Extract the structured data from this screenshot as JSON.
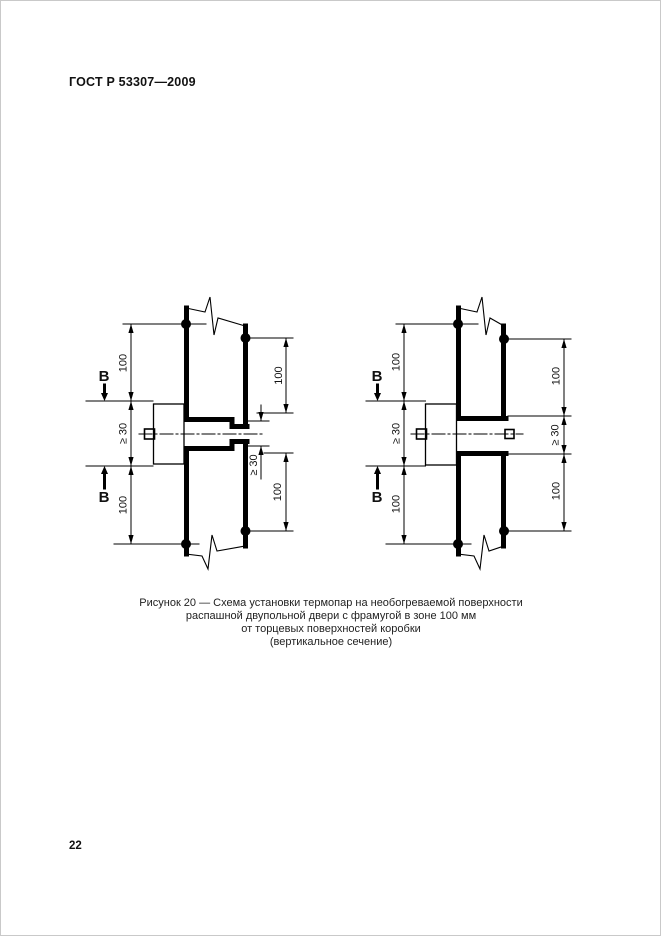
{
  "header": {
    "title": "ГОСТ Р 53307—2009"
  },
  "footer": {
    "page_number": "22"
  },
  "figure": {
    "caption_lines": [
      "Рисунок 20 — Схема установки термопар на необогреваемой поверхности",
      "распашной двупольной двери с фрамугой в зоне 100 мм",
      "от торцевых поверхностей коробки",
      "(вертикальное сечение)"
    ]
  },
  "dimensions": {
    "hundred": "100",
    "min_30": "≥ 30"
  },
  "section_marker": {
    "label": "B"
  },
  "colors": {
    "ink": "#000000",
    "background": "#ffffff"
  }
}
